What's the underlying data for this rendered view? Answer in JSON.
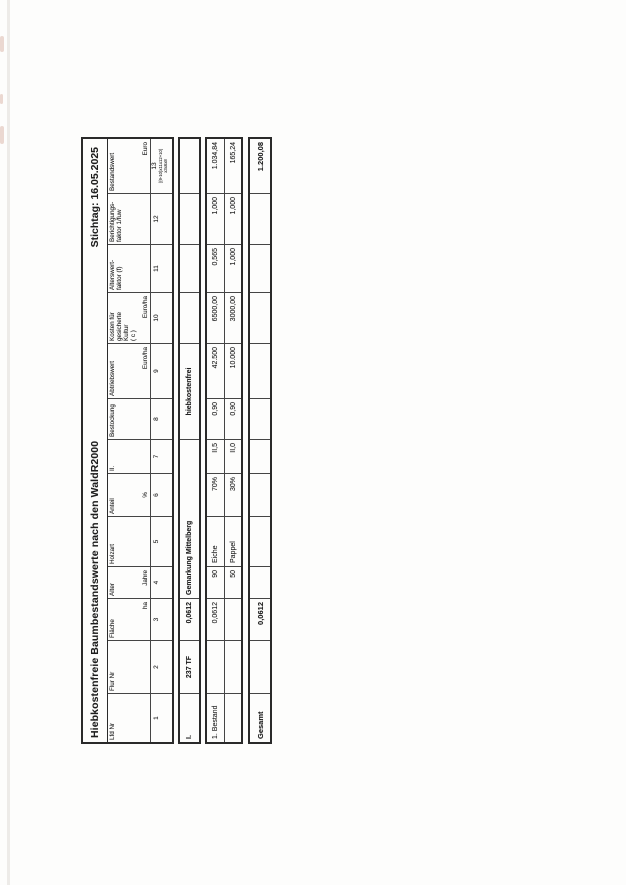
{
  "doc": {
    "title": "Hiebkostenfreie Baumbestandswerte nach den WaldR2000",
    "stichtag": "Stichtag: 16.05.2025"
  },
  "table": {
    "columns": [
      {
        "name": "Lfd Nr",
        "unit": "",
        "num": "1"
      },
      {
        "name": "Flur Nr",
        "unit": "",
        "num": "2"
      },
      {
        "name": "Fläche",
        "unit": "ha",
        "num": "3"
      },
      {
        "name": "Alter",
        "unit": "Jahre",
        "num": "4"
      },
      {
        "name": "Holzart",
        "unit": "",
        "num": "5"
      },
      {
        "name": "Anteil",
        "unit": "%",
        "num": "6"
      },
      {
        "name": "II.",
        "unit": "",
        "num": "7"
      },
      {
        "name": "Bestockung",
        "unit": "",
        "num": "8"
      },
      {
        "name": "Abtriebswert",
        "unit": "Euro/ha",
        "num": "9"
      },
      {
        "name": "Kosten für\ngesicherte\nKultur\n( c )",
        "unit": "Euro/ha",
        "num": "10"
      },
      {
        "name": "Alterswert-\nfaktor (f)",
        "unit": "",
        "num": "11"
      },
      {
        "name": "Berichtigungs-\nfaktor 1/fuw",
        "unit": "",
        "num": "12"
      },
      {
        "name": "Bestandswert",
        "unit": "Euro",
        "num": "13",
        "formula1": "((9-10)x11x12+10)",
        "formula2": "x3x6x8"
      }
    ],
    "section_row": {
      "lfd": "I.",
      "flur": "237 TF",
      "flaeche": "0,0612",
      "gemarkung": "Gemarkung Mittelberg",
      "note": "hiebkostenfrei"
    },
    "stand_rows": [
      {
        "label": "1. Bestand",
        "flur": "",
        "flaeche": "0,0612",
        "alter": "90",
        "holzart": "Eiche",
        "anteil": "70%",
        "ekl": "II,5",
        "bestockung": "0,90",
        "abtriebswert": "42.500",
        "kosten": "6500,00",
        "faktor": "0,565",
        "fuw": "1,000",
        "wert": "1.034,84"
      },
      {
        "label": "",
        "flur": "",
        "flaeche": "",
        "alter": "50",
        "holzart": "Pappel",
        "anteil": "30%",
        "ekl": "II,0",
        "bestockung": "0,90",
        "abtriebswert": "10.000",
        "kosten": "3000,00",
        "faktor": "1,000",
        "fuw": "1,000",
        "wert": "165,24"
      }
    ],
    "total_row": {
      "label": "Gesamt",
      "flaeche": "0,0612",
      "wert": "1.200,08"
    }
  }
}
